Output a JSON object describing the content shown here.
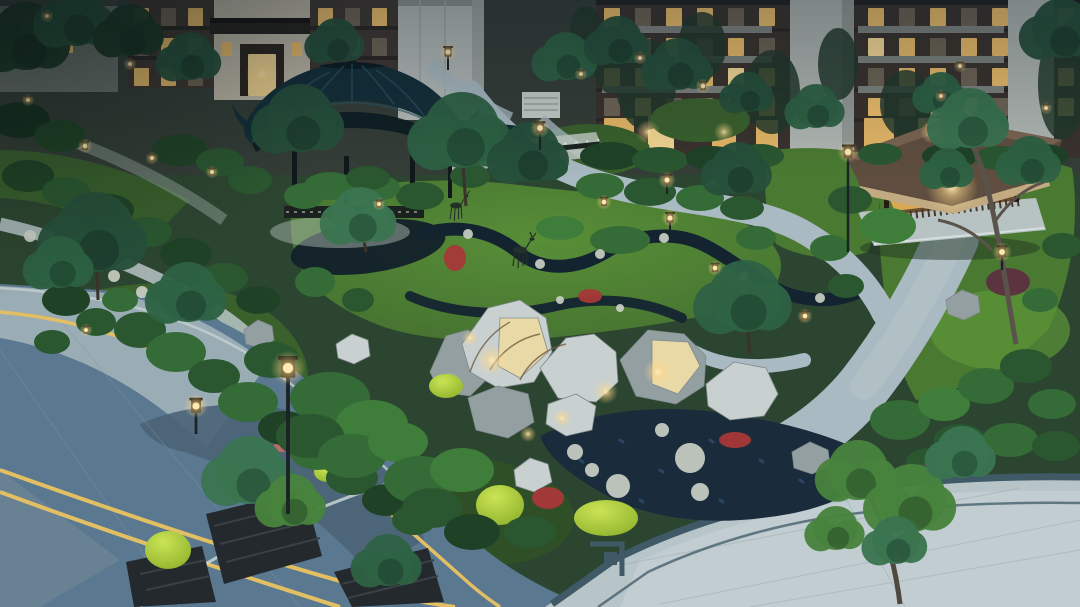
{
  "scene": {
    "title": "Dusk aerial view of a Chinese-style residential community garden with pavilion, rockery, lawns, winding paths, road and paved plaza",
    "objects": [
      "residential-buildings",
      "chinese-pavilion",
      "timber-gazebo",
      "limestone-rockery-with-uplights",
      "deer-sculptures",
      "black-mulch-stream",
      "gravel-bed-with-stepping-stones",
      "community-road-with-yellow-lines",
      "paved-plaza-with-fret-border",
      "planter-boxes",
      "street-lamp",
      "garden-lanterns",
      "clipped-shrubs",
      "lawns"
    ],
    "palette": {
      "base-dusk": "#2c4530",
      "bldg-backdrop": "#343d36",
      "bldg-dark": "#3f3631",
      "bldg-floor": "#2a2522",
      "bldg-stone": "#c2bbaa",
      "bldg-canopy": "#26211e",
      "bldg-gray": "#b6bcb8",
      "bldg-gray-shade": "#a0a6a2",
      "bldg-column": "#b2b8b3",
      "bldg-slab": "#8e958f",
      "door-recess": "#2b241f",
      "door-glow": "#f3cb7c",
      "window-warm": "#f0c06a",
      "window-bright": "#ffe09a",
      "window-dim": "#6f6454",
      "roof-teal": "#132e38",
      "roof-teal-dark": "#0b1b21",
      "roof-teal-rib": "#2a5563",
      "wood-dark": "#10181b",
      "wall-white": "#c3ccc6",
      "fence-dark": "#1c2420",
      "gazebo-roof": "#5f4e3f",
      "gazebo-roof-hi": "#7a6550",
      "gazebo-fascia": "#c2ab83",
      "gazebo-glow": "#d9a855",
      "gazebo-wood": "#8a6436",
      "platform": "#b7c2c3",
      "path-light": "#a9bac2",
      "path-pale": "#b9c6c7",
      "lawn-mid": "#4a7a31",
      "lawn-bright": "#5c9538",
      "lawn-dusk": "#3a612c",
      "lawn-dark": "#2f5026",
      "mulch": "#12202a",
      "gravel": "#1a2b3c",
      "gravel-speck": "#2e4d6b",
      "rock-light": "#c9d0d0",
      "rock-mid": "#949fa2",
      "rock-dark": "#6d797c",
      "rock-warm": "#e9d9a6",
      "stone-pale": "#c9cfc4",
      "red-flower": "#a63838",
      "pink-flower": "#c06a6a",
      "maroon-shrub": "#5c3040",
      "chartreuse": "#b8d840",
      "turf": "#4f9a33",
      "road-light": "#9aacb4",
      "road-dark": "#5b7891",
      "road-shadow": "#4a6377",
      "road-corner": "#6b8494",
      "line-yellow": "#e3bf63",
      "line-white": "#cfdbdb",
      "curb": "#c6d2d2",
      "plaza": "#b7c4c8",
      "plaza-inner": "#c2ced1",
      "plaza-border": "#3f5a66",
      "planter": "#23292d",
      "planter-slat": "#3a4145",
      "trunk": "#4e4840",
      "branch": "#6e5d44",
      "deer": "#233029",
      "lamp-post": "#1b2225",
      "lamp-body": "#241d15",
      "glow-core": "#ffeab2"
    },
    "shrub_greens": [
      "#16301f",
      "#1f4226",
      "#2a5730",
      "#346b36",
      "#3f7d3a",
      "#4f9140"
    ],
    "tree_greens": [
      "#1c3826",
      "#26503a",
      "#2e6244",
      "#3a7550",
      "#48833d",
      "#33684a"
    ]
  },
  "buildings": {
    "window_grids": [
      {
        "x": 134,
        "y": 8,
        "dx": 27,
        "dy": 30,
        "w": 15,
        "h": 18,
        "rows": [
          "wdw",
          "dww",
          "wwd"
        ]
      },
      {
        "x": 318,
        "y": 8,
        "dx": 27,
        "dy": 30,
        "w": 15,
        "h": 18,
        "rows": [
          "wdw",
          "dwd",
          "wwd"
        ]
      },
      {
        "x": 604,
        "y": 8,
        "dx": 31,
        "dy": 30,
        "w": 16,
        "h": 18,
        "rows": [
          "wdwwdw",
          "dwwdwd",
          "wwdwbw",
          "dwdwww"
        ]
      },
      {
        "x": 868,
        "y": 8,
        "dx": 31,
        "dy": 30,
        "w": 16,
        "h": 18,
        "rows": [
          "wdwdw",
          "bwdww",
          "dwwdw",
          "wdwwd"
        ]
      },
      {
        "x": 1058,
        "y": 8,
        "dx": 0,
        "dy": 30,
        "w": 16,
        "h": 18,
        "rows": [
          "w",
          "d",
          "w",
          "w"
        ]
      },
      {
        "x": 8,
        "y": 10,
        "dx": 26,
        "dy": 28,
        "w": 13,
        "h": 15,
        "rows": [
          "dwd",
          "ddw"
        ]
      }
    ],
    "doors": [
      [
        248,
        54,
        28,
        42,
        "b"
      ],
      [
        604,
        118,
        30,
        36,
        "w"
      ],
      [
        648,
        116,
        26,
        38,
        "b"
      ],
      [
        712,
        118,
        24,
        36,
        "w"
      ],
      [
        756,
        120,
        22,
        34,
        "w"
      ],
      [
        864,
        118,
        30,
        36,
        "w"
      ],
      [
        918,
        118,
        26,
        36,
        "b"
      ],
      [
        962,
        120,
        24,
        34,
        "w"
      ]
    ]
  },
  "garden": {
    "shrubs": [
      [
        140,
        330,
        26,
        18,
        2
      ],
      [
        176,
        352,
        30,
        20,
        3
      ],
      [
        214,
        376,
        26,
        17,
        2
      ],
      [
        248,
        402,
        30,
        20,
        3
      ],
      [
        284,
        428,
        26,
        17,
        1
      ],
      [
        318,
        452,
        28,
        18,
        3
      ],
      [
        352,
        478,
        26,
        17,
        2
      ],
      [
        386,
        500,
        24,
        16,
        1
      ],
      [
        414,
        520,
        22,
        15,
        2
      ],
      [
        66,
        300,
        24,
        16,
        1
      ],
      [
        96,
        322,
        20,
        14,
        2
      ],
      [
        52,
        342,
        18,
        12,
        2
      ],
      [
        120,
        300,
        18,
        12,
        3
      ],
      [
        28,
        176,
        26,
        16,
        1
      ],
      [
        66,
        192,
        24,
        15,
        2
      ],
      [
        108,
        210,
        26,
        16,
        1
      ],
      [
        148,
        232,
        24,
        15,
        2
      ],
      [
        186,
        254,
        26,
        16,
        1
      ],
      [
        224,
        278,
        24,
        15,
        2
      ],
      [
        258,
        300,
        22,
        14,
        1
      ],
      [
        20,
        120,
        30,
        18,
        0
      ],
      [
        60,
        136,
        26,
        16,
        1
      ],
      [
        250,
        180,
        22,
        14,
        2
      ],
      [
        304,
        196,
        20,
        13,
        3
      ],
      [
        420,
        196,
        24,
        14,
        2
      ],
      [
        382,
        188,
        18,
        12,
        3
      ],
      [
        470,
        176,
        20,
        12,
        2
      ],
      [
        510,
        172,
        18,
        11,
        2
      ],
      [
        550,
        168,
        18,
        11,
        2
      ],
      [
        330,
        186,
        26,
        14,
        3
      ],
      [
        368,
        178,
        22,
        12,
        2
      ],
      [
        600,
        186,
        24,
        13,
        3
      ],
      [
        650,
        192,
        26,
        14,
        2
      ],
      [
        700,
        198,
        24,
        13,
        3
      ],
      [
        742,
        208,
        22,
        12,
        2
      ],
      [
        330,
        398,
        40,
        26,
        3
      ],
      [
        372,
        424,
        36,
        24,
        4
      ],
      [
        310,
        436,
        34,
        22,
        2
      ],
      [
        352,
        456,
        34,
        22,
        3
      ],
      [
        398,
        442,
        30,
        20,
        4
      ],
      [
        272,
        360,
        28,
        18,
        2
      ],
      [
        420,
        480,
        36,
        24,
        3
      ],
      [
        462,
        470,
        32,
        22,
        4
      ],
      [
        432,
        508,
        30,
        20,
        2
      ],
      [
        472,
        532,
        28,
        18,
        1
      ],
      [
        530,
        532,
        26,
        16,
        2
      ],
      [
        900,
        420,
        30,
        20,
        3
      ],
      [
        944,
        404,
        26,
        17,
        4
      ],
      [
        986,
        386,
        28,
        18,
        3
      ],
      [
        1026,
        366,
        26,
        17,
        2
      ],
      [
        1052,
        404,
        24,
        15,
        3
      ],
      [
        960,
        440,
        26,
        16,
        2
      ],
      [
        1010,
        440,
        28,
        17,
        3
      ],
      [
        1056,
        446,
        24,
        15,
        2
      ],
      [
        888,
        226,
        28,
        18,
        4
      ],
      [
        850,
        200,
        22,
        14,
        2
      ],
      [
        830,
        248,
        20,
        13,
        3
      ],
      [
        846,
        286,
        18,
        12,
        2
      ],
      [
        1062,
        246,
        20,
        13,
        2
      ],
      [
        1040,
        300,
        18,
        12,
        3
      ],
      [
        610,
        156,
        30,
        14,
        1
      ],
      [
        660,
        160,
        28,
        13,
        2
      ],
      [
        712,
        158,
        26,
        12,
        1
      ],
      [
        760,
        156,
        24,
        12,
        2
      ],
      [
        950,
        156,
        28,
        13,
        1
      ],
      [
        1000,
        158,
        26,
        12,
        2
      ],
      [
        1044,
        156,
        24,
        12,
        1
      ],
      [
        880,
        154,
        22,
        11,
        2
      ],
      [
        180,
        150,
        28,
        16,
        1
      ],
      [
        220,
        162,
        24,
        14,
        2
      ],
      [
        315,
        282,
        20,
        15,
        3
      ],
      [
        358,
        300,
        16,
        12,
        2
      ],
      [
        930,
        462,
        24,
        14,
        2
      ],
      [
        620,
        240,
        30,
        14,
        3
      ],
      [
        560,
        228,
        24,
        12,
        4
      ],
      [
        756,
        238,
        20,
        12,
        3
      ]
    ],
    "trees": [
      [
        26,
        36,
        34,
        0
      ],
      [
        76,
        16,
        30,
        1
      ],
      [
        130,
        30,
        26,
        0
      ],
      [
        190,
        56,
        24,
        1
      ],
      [
        336,
        40,
        22,
        1
      ],
      [
        566,
        56,
        24,
        2
      ],
      [
        618,
        40,
        24,
        1
      ],
      [
        678,
        64,
        26,
        1
      ],
      [
        748,
        92,
        20,
        1
      ],
      [
        816,
        106,
        22,
        2
      ],
      [
        1062,
        28,
        30,
        1
      ],
      [
        941,
        92,
        20,
        2
      ],
      [
        95,
        232,
        40,
        1,
        98,
        300,
        96,
        250
      ],
      [
        60,
        262,
        26,
        2
      ],
      [
        188,
        292,
        30,
        2
      ],
      [
        300,
        118,
        34,
        1
      ],
      [
        360,
        215,
        28,
        3,
        366,
        252,
        362,
        230
      ],
      [
        462,
        130,
        38,
        2,
        466,
        206,
        462,
        152
      ],
      [
        530,
        152,
        30,
        1
      ],
      [
        745,
        296,
        36,
        2,
        750,
        354,
        746,
        316
      ],
      [
        738,
        168,
        26,
        1
      ],
      [
        970,
        118,
        30,
        3
      ],
      [
        1030,
        160,
        24,
        2
      ],
      [
        948,
        168,
        20,
        2
      ],
      [
        858,
        470,
        30,
        4
      ],
      [
        912,
        498,
        34,
        4
      ],
      [
        962,
        452,
        26,
        3
      ],
      [
        836,
        528,
        22,
        4
      ],
      [
        896,
        540,
        24,
        3
      ],
      [
        250,
        470,
        34,
        3
      ],
      [
        292,
        500,
        26,
        4
      ],
      [
        388,
        560,
        26,
        2
      ]
    ],
    "lamps": [
      [
        288,
        368,
        1.6,
        146
      ],
      [
        196,
        406,
        1.1,
        28
      ],
      [
        448,
        52,
        0.8,
        18
      ],
      [
        540,
        128,
        0.9,
        22
      ],
      [
        667,
        180,
        0.8,
        14
      ],
      [
        703,
        86,
        0.7,
        0
      ],
      [
        848,
        152,
        1.0,
        100
      ],
      [
        1002,
        252,
        0.9,
        18
      ],
      [
        670,
        218,
        0.8,
        12
      ],
      [
        604,
        202,
        0.7,
        0
      ],
      [
        85,
        146,
        0.7,
        0
      ],
      [
        47,
        16,
        0.6,
        0
      ],
      [
        130,
        64,
        0.6,
        0
      ],
      [
        152,
        158,
        0.6,
        0
      ],
      [
        212,
        172,
        0.6,
        0
      ],
      [
        28,
        100,
        0.6,
        0
      ],
      [
        581,
        74,
        0.6,
        0
      ],
      [
        640,
        58,
        0.6,
        0
      ],
      [
        379,
        204,
        0.6,
        0
      ],
      [
        86,
        330,
        0.6,
        0
      ],
      [
        715,
        268,
        0.7,
        0
      ],
      [
        805,
        316,
        0.7,
        0
      ],
      [
        941,
        96,
        0.6,
        0
      ],
      [
        1046,
        108,
        0.6,
        0
      ],
      [
        960,
        66,
        0.6,
        0
      ]
    ],
    "glows": [
      [
        492,
        360,
        16
      ],
      [
        658,
        372,
        14
      ],
      [
        450,
        382,
        10
      ],
      [
        606,
        392,
        12
      ],
      [
        562,
        418,
        9
      ],
      [
        470,
        338,
        8
      ],
      [
        528,
        434,
        8
      ],
      [
        262,
        74,
        16
      ],
      [
        952,
        188,
        26
      ],
      [
        648,
        132,
        12
      ],
      [
        724,
        132,
        10
      ],
      [
        932,
        132,
        12
      ]
    ],
    "stones": [
      [
        690,
        458,
        15
      ],
      [
        618,
        486,
        12
      ],
      [
        575,
        452,
        8
      ],
      [
        700,
        492,
        9
      ],
      [
        662,
        430,
        7
      ],
      [
        592,
        470,
        7
      ],
      [
        468,
        234,
        5
      ],
      [
        540,
        264,
        5
      ],
      [
        600,
        254,
        5
      ],
      [
        664,
        238,
        5
      ],
      [
        744,
        276,
        5
      ],
      [
        820,
        298,
        5
      ],
      [
        560,
        300,
        4
      ],
      [
        620,
        308,
        4
      ],
      [
        30,
        236,
        6
      ],
      [
        58,
        248,
        6
      ],
      [
        86,
        262,
        6
      ],
      [
        114,
        276,
        6
      ],
      [
        142,
        292,
        6
      ]
    ],
    "rocks": [
      {
        "p": "430,372 446,336 468,330 486,344 492,374 470,396 440,392",
        "c": "mid"
      },
      {
        "p": "462,344 488,308 520,300 546,318 552,352 534,382 498,388 470,372",
        "c": "light"
      },
      {
        "p": "500,318 538,318 548,352 520,378 498,366",
        "c": "warm"
      },
      {
        "p": "540,368 566,338 594,334 616,352 618,382 596,402 558,398",
        "c": "light"
      },
      {
        "p": "620,360 648,330 684,334 706,356 704,386 676,404 636,396",
        "c": "mid"
      },
      {
        "p": "652,340 688,342 700,366 678,394 652,384",
        "c": "warm"
      },
      {
        "p": "706,384 734,362 766,368 778,394 764,416 730,420 708,406",
        "c": "light"
      },
      {
        "p": "468,398 498,386 528,394 534,422 508,438 476,430",
        "c": "mid"
      },
      {
        "p": "548,404 576,394 596,406 592,430 566,436 546,424",
        "c": "light"
      },
      {
        "p": "244,330 258,320 272,326 274,340 260,348 246,344",
        "c": "mid"
      },
      {
        "p": "336,344 352,334 368,340 370,356 354,364 338,358",
        "c": "light"
      },
      {
        "p": "514,470 530,458 548,464 552,482 534,492 516,486",
        "c": "light"
      },
      {
        "p": "792,452 810,442 828,450 830,466 812,474 794,468",
        "c": "mid"
      },
      {
        "p": "946,300 962,290 978,296 980,312 964,320 948,314",
        "c": "mid"
      }
    ],
    "flowers": [
      [
        548,
        498,
        16,
        11,
        "r"
      ],
      [
        735,
        440,
        16,
        8,
        "r"
      ],
      [
        455,
        258,
        11,
        13,
        "r"
      ],
      [
        282,
        446,
        8,
        6,
        "p"
      ],
      [
        590,
        296,
        12,
        7,
        "r"
      ],
      [
        1008,
        282,
        22,
        14,
        "m"
      ]
    ],
    "mounds": [
      [
        500,
        505,
        24,
        20
      ],
      [
        606,
        518,
        32,
        18
      ],
      [
        168,
        550,
        23,
        19
      ],
      [
        446,
        386,
        17,
        12
      ],
      [
        328,
        472,
        14,
        10
      ]
    ]
  }
}
